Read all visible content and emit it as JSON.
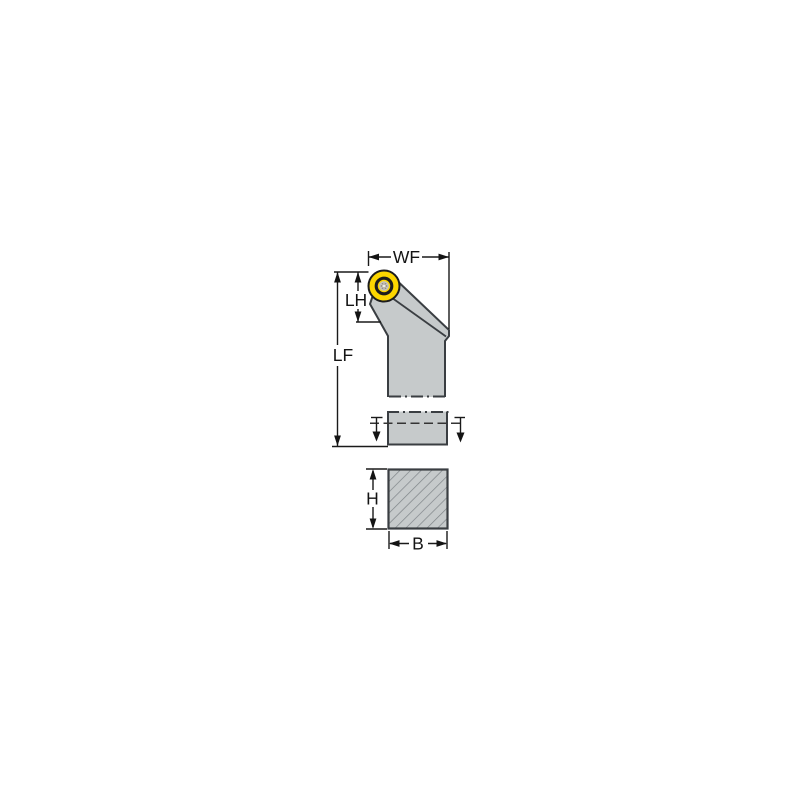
{
  "diagram": {
    "type": "technical-drawing",
    "subject": "lathe toolholder with round yellow insert: front view with breakout shank section and square shank cross-section",
    "dimension_labels": {
      "wf": "WF",
      "lh": "LH",
      "lf": "LF",
      "h": "H",
      "b": "B"
    },
    "colors": {
      "background": "#ffffff",
      "body_fill": "#c6cacb",
      "outline": "#3a3e42",
      "dimension": "#1a1a1a",
      "insert_yellow": "#fcd600",
      "insert_ring": "#1c1c1c",
      "screw_gray": "#8e8a80",
      "hatch": "#7e8387"
    }
  }
}
